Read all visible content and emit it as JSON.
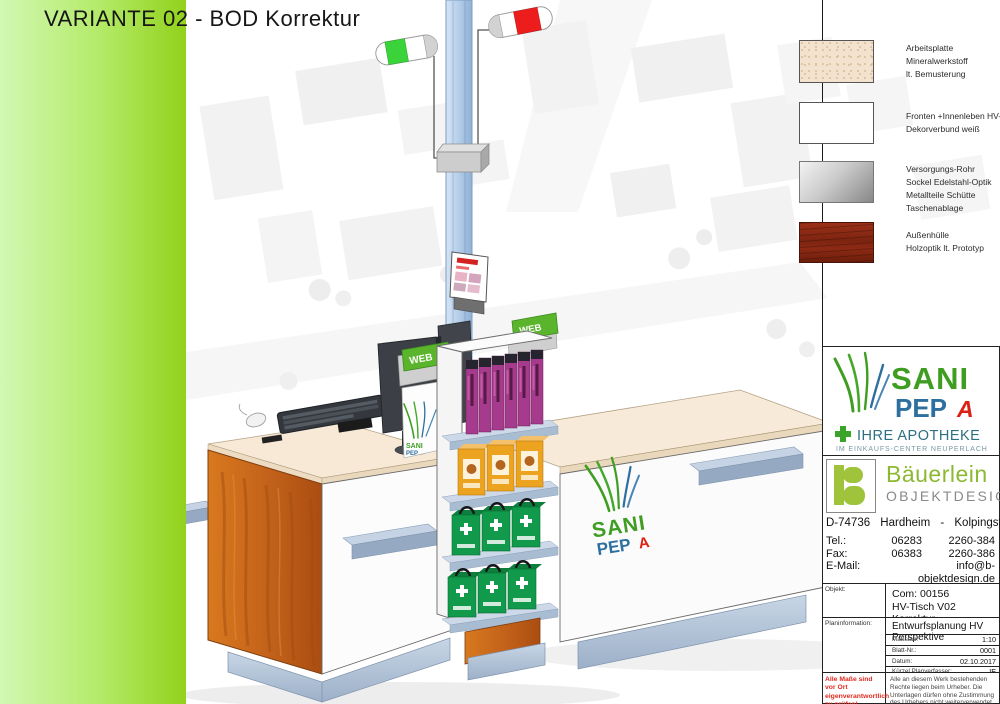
{
  "title": "VARIANTE 02 - BOD Korrektur",
  "legend": {
    "items": [
      {
        "material": "mineral",
        "lines": [
          "Arbeitsplatte",
          "Mineralwerkstoff",
          "lt. Bemusterung"
        ]
      },
      {
        "material": "white-decor",
        "lines": [
          "Fronten +Innenleben HV-Tisch",
          "Dekorverbund weiß"
        ]
      },
      {
        "material": "stainless",
        "lines": [
          "Versorgungs-Rohr",
          "Sockel Edelstahl-Optik",
          "Metallteile Schütte",
          "Taschenablage"
        ]
      },
      {
        "material": "wood",
        "lines": [
          "Außenhülle",
          "Holzoptik lt. Prototyp"
        ]
      }
    ]
  },
  "brand": {
    "sani": "SANI",
    "pep": "PEP",
    "a": "A",
    "tagline": "IHRE APOTHEKE",
    "subline": "IM EINKAUFS-CENTER NEUPERLACH"
  },
  "company": {
    "logo_letter": "B",
    "name": "Bäuerlein",
    "division": "OBJEKTDESIGN",
    "address": "D-74736 Hardheim - Kolpingstr. 52",
    "contacts": [
      {
        "label": "Tel.:",
        "col1": "06283",
        "col2": "2260-384"
      },
      {
        "label": "Fax:",
        "col1": "06383",
        "col2": "2260-386"
      },
      {
        "label": "E-Mail:",
        "col1": "",
        "col2": "info@b-objektdesign.de"
      },
      {
        "label": "Web:",
        "col1": "",
        "col2": "www.b-objektdesign.de"
      }
    ]
  },
  "plan": {
    "objekt_label": "Objekt:",
    "commission": "Com: 00156",
    "project": "HV-Tisch V02 Korrektur",
    "planinfo_label": "Planinformation:",
    "plan_title": "Entwurfsplanung HV Perspektive",
    "meta": [
      {
        "label": "Maßstab:",
        "value": "1:10"
      },
      {
        "label": "Blatt-Nr.:",
        "value": "0001"
      },
      {
        "label": "Datum:",
        "value": "02.10.2017"
      },
      {
        "label": "Kürzel Planverfasser:",
        "value": "IE"
      }
    ],
    "warning": "Alle Maße sind vor Ort eigenverantwortlich zu prüfen!",
    "copyright": "Alle an diesem Werk bestehenden Rechte liegen beim Urheber. Die Unterlagen dürfen ohne Zustimmung des Urhebers nicht weiterverwendet, oder Dritten zugänglich gemacht werden."
  },
  "scene": {
    "web_sign_label": "WEB",
    "counter_logo": {
      "sani": "SANI",
      "pep": "PEP",
      "a": "A"
    }
  },
  "colors": {
    "accent_green": "#92d11c",
    "sani_green": "#3f9e22",
    "pep_blue": "#2d6f9e",
    "apotheke_red": "#dd2014",
    "company_green": "#9fc43c",
    "signal_green": "#3ad43a",
    "signal_red": "#ee1d1d"
  }
}
